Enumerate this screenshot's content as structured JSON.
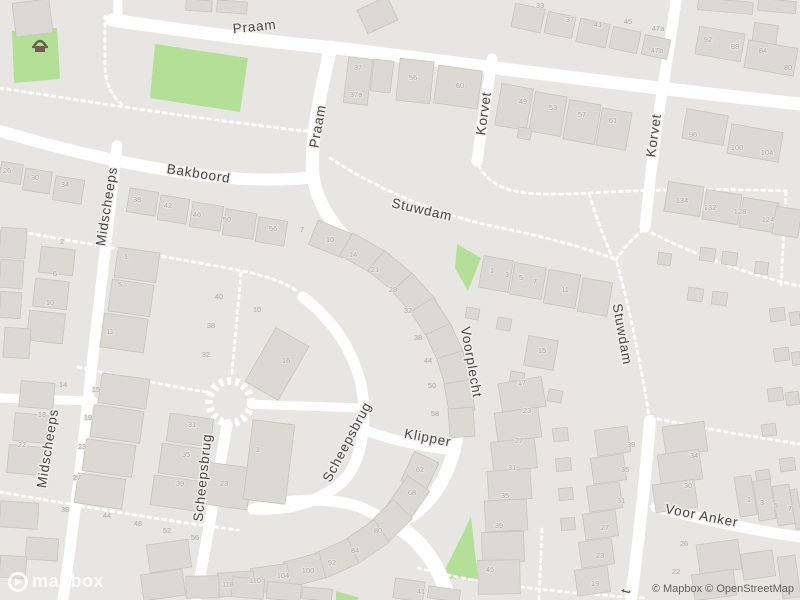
{
  "branding": {
    "logo_text": "mapbox",
    "attribution": "© Mapbox © OpenStreetMap"
  },
  "colors": {
    "background": "#e8e6e2",
    "road": "#ffffff",
    "building": "#dcd8d3",
    "building_outline": "#c8c4bf",
    "green": "#b3e096",
    "street_label": "#474747",
    "house_number": "#aeaaa5",
    "poi_icon": "#6f5d52"
  },
  "map": {
    "poi": [
      {
        "name": "playground-icon",
        "x": 40,
        "y": 40
      }
    ],
    "streets": [
      {
        "name": "Praam",
        "x": 255,
        "y": 31,
        "rot": -6,
        "size": 13.5
      },
      {
        "name": "Praam",
        "x": 322,
        "y": 127,
        "rot": -80,
        "size": 13.5
      },
      {
        "name": "Bakboord",
        "x": 198,
        "y": 178,
        "rot": 9,
        "size": 13.5
      },
      {
        "name": "Midscheeps",
        "x": 111,
        "y": 207,
        "rot": -81,
        "size": 13.5
      },
      {
        "name": "Midscheeps",
        "x": 52,
        "y": 449,
        "rot": -81,
        "size": 13.5
      },
      {
        "name": "Korvet",
        "x": 488,
        "y": 114,
        "rot": -82,
        "size": 13.5
      },
      {
        "name": "Korvet",
        "x": 658,
        "y": 136,
        "rot": -82,
        "size": 13.5
      },
      {
        "name": "Stuwdam",
        "x": 421,
        "y": 214,
        "rot": 13,
        "size": 13.5
      },
      {
        "name": "Stuwdam",
        "x": 618,
        "y": 335,
        "rot": 80,
        "size": 13.5
      },
      {
        "name": "Voorplecht",
        "x": 467,
        "y": 363,
        "rot": 80,
        "size": 13.5
      },
      {
        "name": "Klipper",
        "x": 427,
        "y": 442,
        "rot": 11,
        "size": 13.5
      },
      {
        "name": "Scheepsbrug",
        "x": 351,
        "y": 444,
        "rot": -62,
        "size": 13.5
      },
      {
        "name": "Scheepsbrug",
        "x": 207,
        "y": 478,
        "rot": -84,
        "size": 13.5
      },
      {
        "name": "Voor Anker",
        "x": 701,
        "y": 520,
        "rot": 11,
        "size": 13.5
      },
      {
        "name": "t",
        "x": 630,
        "y": 592,
        "rot": -75,
        "size": 13.5
      }
    ],
    "house_numbers": [
      {
        "t": "33",
        "x": 540,
        "y": 8
      },
      {
        "t": "37",
        "x": 570,
        "y": 22
      },
      {
        "t": "41",
        "x": 598,
        "y": 27
      },
      {
        "t": "45",
        "x": 628,
        "y": 24
      },
      {
        "t": "47a",
        "x": 658,
        "y": 31
      },
      {
        "t": "47b",
        "x": 657,
        "y": 53
      },
      {
        "t": "92",
        "x": 708,
        "y": 42
      },
      {
        "t": "88",
        "x": 735,
        "y": 49
      },
      {
        "t": "84",
        "x": 763,
        "y": 53
      },
      {
        "t": "80",
        "x": 788,
        "y": 70
      },
      {
        "t": "96",
        "x": 693,
        "y": 137
      },
      {
        "t": "100",
        "x": 737,
        "y": 150
      },
      {
        "t": "104",
        "x": 767,
        "y": 155
      },
      {
        "t": "37",
        "x": 358,
        "y": 70
      },
      {
        "t": "37a",
        "x": 356,
        "y": 97
      },
      {
        "t": "56",
        "x": 413,
        "y": 80
      },
      {
        "t": "60",
        "x": 460,
        "y": 88
      },
      {
        "t": "49",
        "x": 523,
        "y": 104
      },
      {
        "t": "53",
        "x": 553,
        "y": 110
      },
      {
        "t": "57",
        "x": 582,
        "y": 117
      },
      {
        "t": "61",
        "x": 613,
        "y": 123
      },
      {
        "t": "134",
        "x": 682,
        "y": 203
      },
      {
        "t": "132",
        "x": 710,
        "y": 210
      },
      {
        "t": "128",
        "x": 740,
        "y": 214
      },
      {
        "t": "124",
        "x": 768,
        "y": 222
      },
      {
        "t": "1",
        "x": 492,
        "y": 273
      },
      {
        "t": "3",
        "x": 507,
        "y": 277
      },
      {
        "t": "5",
        "x": 521,
        "y": 280
      },
      {
        "t": "7",
        "x": 535,
        "y": 284
      },
      {
        "t": "11",
        "x": 565,
        "y": 292
      },
      {
        "t": "15",
        "x": 542,
        "y": 353
      },
      {
        "t": "26",
        "x": 7,
        "y": 173
      },
      {
        "t": "30",
        "x": 35,
        "y": 180
      },
      {
        "t": "34",
        "x": 65,
        "y": 187
      },
      {
        "t": "38",
        "x": 137,
        "y": 202
      },
      {
        "t": "42",
        "x": 168,
        "y": 208
      },
      {
        "t": "46",
        "x": 197,
        "y": 217
      },
      {
        "t": "50",
        "x": 227,
        "y": 222
      },
      {
        "t": "56",
        "x": 273,
        "y": 231
      },
      {
        "t": "2",
        "x": 62,
        "y": 244
      },
      {
        "t": "6",
        "x": 55,
        "y": 276
      },
      {
        "t": "10",
        "x": 50,
        "y": 305
      },
      {
        "t": "1",
        "x": 126,
        "y": 259
      },
      {
        "t": "5",
        "x": 120,
        "y": 287
      },
      {
        "t": "11",
        "x": 110,
        "y": 334
      },
      {
        "t": "40",
        "x": 219,
        "y": 299
      },
      {
        "t": "38",
        "x": 211,
        "y": 328
      },
      {
        "t": "10",
        "x": 257,
        "y": 312
      },
      {
        "t": "32",
        "x": 206,
        "y": 357
      },
      {
        "t": "16",
        "x": 286,
        "y": 363
      },
      {
        "t": "1",
        "x": 258,
        "y": 452
      },
      {
        "t": "23",
        "x": 224,
        "y": 486
      },
      {
        "t": "14",
        "x": 63,
        "y": 387
      },
      {
        "t": "18",
        "x": 42,
        "y": 417
      },
      {
        "t": "22",
        "x": 22,
        "y": 447
      },
      {
        "t": "15",
        "x": 96,
        "y": 392
      },
      {
        "t": "19",
        "x": 88,
        "y": 420
      },
      {
        "t": "23",
        "x": 82,
        "y": 449
      },
      {
        "t": "27",
        "x": 77,
        "y": 480
      },
      {
        "t": "31",
        "x": 192,
        "y": 427
      },
      {
        "t": "35",
        "x": 186,
        "y": 457
      },
      {
        "t": "39",
        "x": 180,
        "y": 486
      },
      {
        "t": "38",
        "x": 65,
        "y": 512
      },
      {
        "t": "44",
        "x": 107,
        "y": 518
      },
      {
        "t": "48",
        "x": 138,
        "y": 526
      },
      {
        "t": "52",
        "x": 167,
        "y": 533
      },
      {
        "t": "56",
        "x": 195,
        "y": 540
      },
      {
        "t": "7",
        "x": 302,
        "y": 232
      },
      {
        "t": "10",
        "x": 330,
        "y": 242
      },
      {
        "t": "14",
        "x": 353,
        "y": 257
      },
      {
        "t": "21",
        "x": 375,
        "y": 272
      },
      {
        "t": "28",
        "x": 393,
        "y": 292
      },
      {
        "t": "32",
        "x": 408,
        "y": 313
      },
      {
        "t": "38",
        "x": 418,
        "y": 340
      },
      {
        "t": "44",
        "x": 428,
        "y": 363
      },
      {
        "t": "50",
        "x": 432,
        "y": 388
      },
      {
        "t": "58",
        "x": 435,
        "y": 416
      },
      {
        "t": "62",
        "x": 420,
        "y": 472
      },
      {
        "t": "68",
        "x": 412,
        "y": 495
      },
      {
        "t": "80",
        "x": 378,
        "y": 533
      },
      {
        "t": "84",
        "x": 355,
        "y": 553
      },
      {
        "t": "92",
        "x": 332,
        "y": 565
      },
      {
        "t": "100",
        "x": 308,
        "y": 573
      },
      {
        "t": "104",
        "x": 283,
        "y": 578
      },
      {
        "t": "110",
        "x": 255,
        "y": 583
      },
      {
        "t": "118",
        "x": 228,
        "y": 587
      },
      {
        "t": "17",
        "x": 522,
        "y": 385
      },
      {
        "t": "23",
        "x": 527,
        "y": 413
      },
      {
        "t": "27",
        "x": 519,
        "y": 443
      },
      {
        "t": "31",
        "x": 512,
        "y": 470
      },
      {
        "t": "35",
        "x": 505,
        "y": 498
      },
      {
        "t": "39",
        "x": 499,
        "y": 528
      },
      {
        "t": "45",
        "x": 490,
        "y": 572
      },
      {
        "t": "39",
        "x": 631,
        "y": 447
      },
      {
        "t": "35",
        "x": 625,
        "y": 472
      },
      {
        "t": "31",
        "x": 621,
        "y": 503
      },
      {
        "t": "27",
        "x": 605,
        "y": 530
      },
      {
        "t": "23",
        "x": 600,
        "y": 558
      },
      {
        "t": "19",
        "x": 595,
        "y": 586
      },
      {
        "t": "34",
        "x": 694,
        "y": 458
      },
      {
        "t": "30",
        "x": 688,
        "y": 488
      },
      {
        "t": "1",
        "x": 749,
        "y": 502
      },
      {
        "t": "3",
        "x": 762,
        "y": 505
      },
      {
        "t": "5",
        "x": 776,
        "y": 508
      },
      {
        "t": "7",
        "x": 790,
        "y": 511
      },
      {
        "t": "26",
        "x": 684,
        "y": 546
      },
      {
        "t": "22",
        "x": 676,
        "y": 574
      },
      {
        "t": "41",
        "x": 421,
        "y": 594
      }
    ]
  }
}
